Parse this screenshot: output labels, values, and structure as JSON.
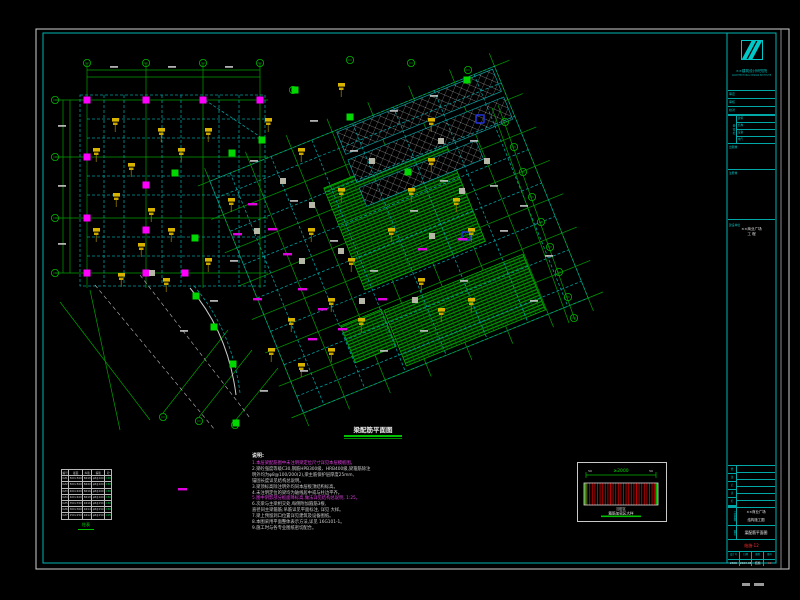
{
  "sheet": {
    "plan_title": "梁配筋平面图",
    "frame_color": "#cccccc",
    "border_color": "#00b4b4",
    "accents": {
      "grid_green": "#00a000",
      "beam_cyan": "#00a8a8",
      "column_magenta": "#ff00ff",
      "callout_yellow": "#d8b400",
      "hatch_green": "#00c000",
      "detail_red": "#c80000"
    }
  },
  "notes": {
    "title": "说明:",
    "lines": [
      {
        "text": "1.本层梁配筋图中未注明梁定位尺寸详见本层模板图。",
        "color": "magenta"
      },
      {
        "text": "2.梁砼强度等级C30,钢筋HPB300级、HRB400级,梁箍筋除注",
        "color": "white"
      },
      {
        "text": "  明外均为φ8@100/200(2),梁主筋保护层厚度25mm,",
        "color": "white"
      },
      {
        "text": "  锚固长度详见结构总说明。",
        "color": "white"
      },
      {
        "text": "3.梁顶标高除注明外均同本层板顶结构标高。",
        "color": "white"
      },
      {
        "text": "4.未注明定位的梁均为轴线居中或与柱边平齐。",
        "color": "white"
      },
      {
        "text": "5.图中阴影部分板面降标高,做法详见结构总说明, 1:25。",
        "color": "magenta"
      },
      {
        "text": "6.次梁与主梁相交处,每侧附加箍筋3根,",
        "color": "white"
      },
      {
        "text": "  直径同主梁箍筋;吊筋详见平面标注, 详见 大样。",
        "color": "white"
      },
      {
        "text": "7.梁上预留洞口位置详见建筑及设备图纸。",
        "color": "white"
      },
      {
        "text": "8.本图采用平面整体表示方法,详见 16G101-1。",
        "color": "white"
      },
      {
        "text": "9.施工时与各专业图纸密切配合。",
        "color": "white"
      }
    ]
  },
  "column_table": {
    "caption": "柱表",
    "headers": [
      "编号",
      "截面",
      "纵筋",
      "箍筋",
      "砼"
    ],
    "rows": [
      [
        "KZ1",
        "500×500",
        "8Φ18",
        "φ8@100",
        "C30"
      ],
      [
        "KZ2",
        "500×500",
        "8Φ20",
        "φ8@100",
        "C30"
      ],
      [
        "KZ3",
        "400×400",
        "8Φ16",
        "φ8@100",
        "C30"
      ],
      [
        "KZ4",
        "400×400",
        "8Φ18",
        "φ8@100",
        "C30"
      ],
      [
        "KZ5",
        "350×350",
        "4Φ16",
        "φ8@150",
        "C30"
      ],
      [
        "KZ6",
        "300×300",
        "4Φ14",
        "φ8@150",
        "C30"
      ],
      [
        "KZ7",
        "250×250",
        "4Φ12",
        "φ8@150",
        "C25"
      ]
    ]
  },
  "detail": {
    "dim_label": "≥2000",
    "left_label": "50",
    "right_label": "50",
    "mid_label": "加密区",
    "caption": "箍筋加密区大样"
  },
  "title_block": {
    "company_line1": "××建筑设计研究院",
    "company_line2": "ARCHITECTURAL DESIGN INSTITUTE",
    "approvals": [
      "审定",
      "审核",
      "校对"
    ],
    "sign_label": "会签栏",
    "sign_rows": [
      "建筑",
      "结构",
      "设备",
      "电气"
    ],
    "boxA_label": "出图章",
    "boxB_label": "注册章",
    "proj_label": "建设单位",
    "project_line1": "××商业广场",
    "project_line2": "工 程",
    "rev_labels": [
      "修",
      "改",
      "记",
      "录",
      "栏",
      ""
    ],
    "name_label": "工程名称",
    "name_line1": "××商业广场",
    "name_line2": "结构施工图",
    "draw_label": "图名",
    "drawing_title": "梁配筋平面图",
    "red_stamp": "结施-12",
    "bottom_cells": [
      {
        "label": "设计号",
        "value": "2308",
        "red": false
      },
      {
        "label": "日期",
        "value": "2023.08",
        "red": false
      },
      {
        "label": "图别",
        "value": "结施",
        "red": false
      },
      {
        "label": "图号",
        "value": "12",
        "red": true
      }
    ]
  }
}
